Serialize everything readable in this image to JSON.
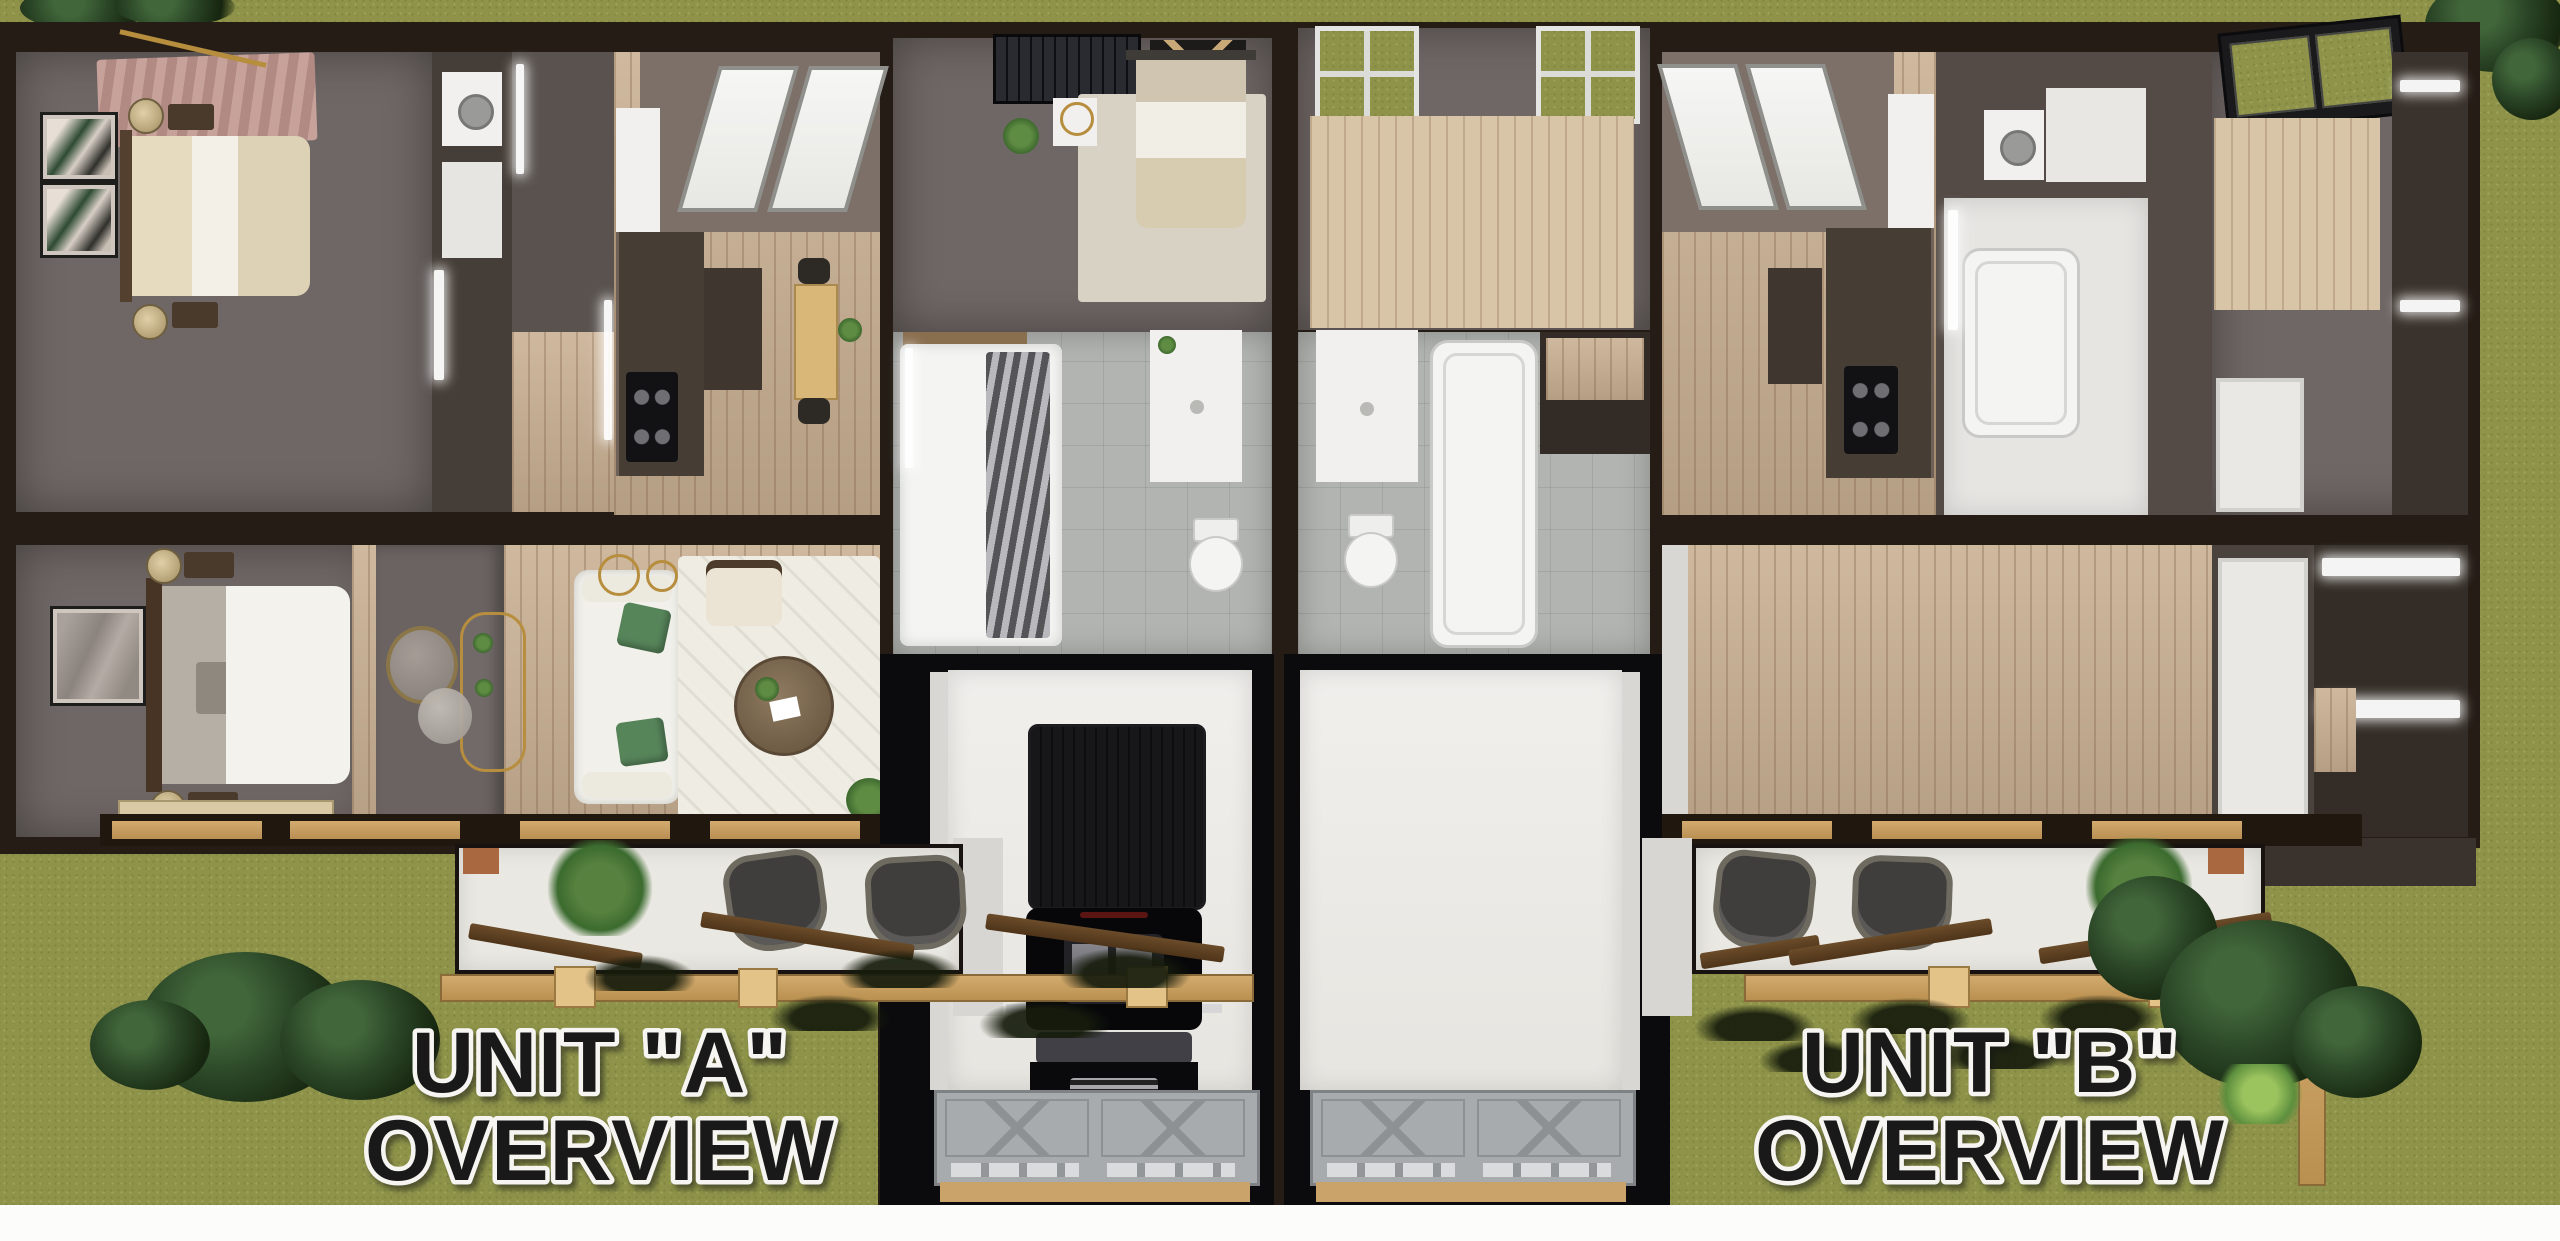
{
  "units": [
    {
      "id": "A",
      "label_line1": "UNIT \"A\"",
      "label_line2": "OVERVIEW"
    },
    {
      "id": "B",
      "label_line1": "UNIT \"B\"",
      "label_line2": "OVERVIEW"
    }
  ],
  "palette": {
    "grass": "#8e9349",
    "wall_dark": "#241c15",
    "wood_floor": "#c9b093",
    "wood_floor_light": "#d8c4a6",
    "room_gray": "#6f6765",
    "tile_gray": "#b2b4b1",
    "patio": "#eae8e2",
    "pergola_wood": "#c9a066",
    "beam_wood": "#5f4526",
    "garage_floor": "#efedea",
    "garage_door": "#a7abad",
    "truck": "#0b0b0d",
    "tree": "#24381f",
    "label_fill": "#191919",
    "label_stroke": "#f6f5f2",
    "bottom_margin": "#fcfcfb"
  }
}
